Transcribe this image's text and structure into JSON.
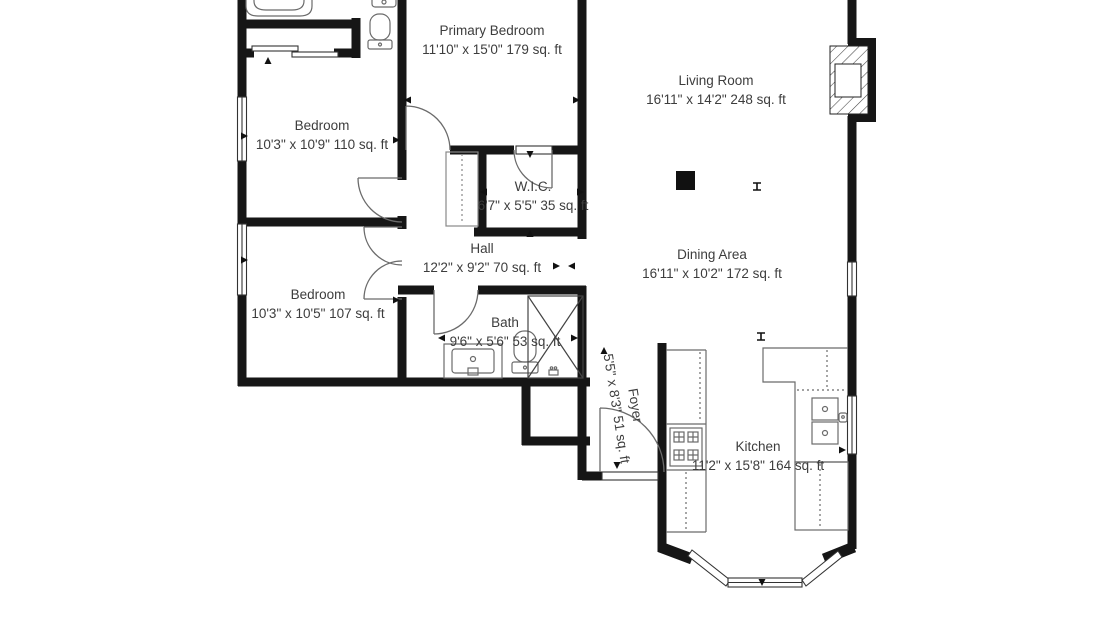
{
  "document": {
    "type": "floor-plan",
    "units": "sq. ft"
  },
  "colors": {
    "wall": "#161616",
    "text": "#3d3d3d",
    "fixture": "#6b6b6b",
    "thin_line": "#333333",
    "background": "#ffffff"
  },
  "rooms": [
    {
      "id": "primary-bedroom",
      "name": "Primary Bedroom",
      "dims": "11'10\" x 15'0\" 179 sq. ft"
    },
    {
      "id": "living-room",
      "name": "Living Room",
      "dims": "16'11\" x 14'2\" 248 sq. ft"
    },
    {
      "id": "bedroom-1",
      "name": "Bedroom",
      "dims": "10'3\" x 10'9\" 110 sq. ft"
    },
    {
      "id": "wic",
      "name": "W.I.C.",
      "dims": "6'7\" x 5'5\" 35 sq. ft"
    },
    {
      "id": "hall",
      "name": "Hall",
      "dims": "12'2\" x 9'2\" 70 sq. ft"
    },
    {
      "id": "dining-area",
      "name": "Dining Area",
      "dims": "16'11\" x 10'2\" 172 sq. ft"
    },
    {
      "id": "bedroom-2",
      "name": "Bedroom",
      "dims": "10'3\" x 10'5\" 107 sq. ft"
    },
    {
      "id": "bath",
      "name": "Bath",
      "dims": "9'6\" x 5'6\" 53 sq. ft"
    },
    {
      "id": "foyer",
      "name": "Foyer",
      "dims": "5'5\" x 8'3\" 51 sq. ft"
    },
    {
      "id": "kitchen",
      "name": "Kitchen",
      "dims": "11'2\" x 15'8\" 164 sq. ft"
    }
  ],
  "icons": [
    "bathtub-icon",
    "toilet-icon",
    "sink-icon",
    "vanity-sink-icon",
    "shower-icon",
    "stove-icon",
    "kitchen-sink-icon",
    "fireplace-icon",
    "column-marker",
    "window-symbol",
    "door-swing-symbol",
    "bay-window",
    "sliding-closet-door",
    "dimension-arrow"
  ]
}
